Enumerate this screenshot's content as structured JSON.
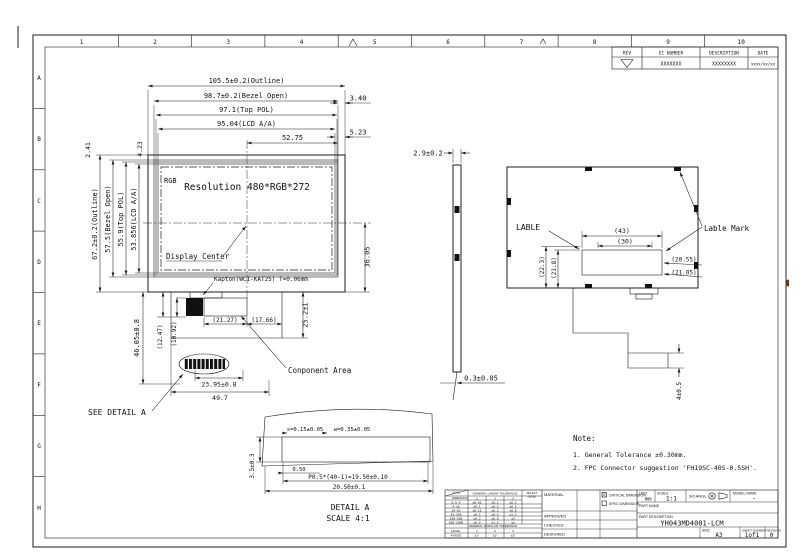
{
  "sheet": {
    "zones_top": [
      "1",
      "2",
      "3",
      "4",
      "5",
      "6",
      "7",
      "8",
      "9",
      "10"
    ],
    "zones_left": [
      "A",
      "B",
      "C",
      "D",
      "E",
      "F",
      "G",
      "H"
    ]
  },
  "rev_table": {
    "headers": [
      "REV",
      "EC NUMBER",
      "DESCRIPTION",
      "DATE"
    ],
    "row": {
      "ec_number": "XXXXXXX",
      "description": "XXXXXXXX",
      "date": "xxxx/xx/xx"
    }
  },
  "front": {
    "dim_outline_w": "105.5±0.2(Outline)",
    "dim_bezel_w": "98.7±0.2(Bezel Open)",
    "dim_pol_w": "97.1(Top POL)",
    "dim_aa_w": "95.04(LCD A/A)",
    "dim_half_w": "52.75",
    "dim_340": "3.40",
    "dim_523": "5.23",
    "dim_241": "2.41",
    "dim_423": "4.23",
    "dim_outline_h": "67.2±0.2(Outline)",
    "dim_bezel_h": "57.5(Bezel Open)",
    "dim_pol_h": "55.9(Top POL)",
    "dim_aa_h": "53.856(LCD A/A)",
    "rgb": "RGB",
    "resolution": "Resolution 480*RGB*272",
    "display_center": "Display Center",
    "kapton": "Kapton(WCI-KAT25) T=0.06mm",
    "dim_3605": "36.05",
    "dim_252": "25.2±1",
    "dim_2127": "(21.27)",
    "dim_1766": "(17.66)",
    "dim_4605": "46.05±0.8",
    "dim_1247": "(12.47)",
    "dim_1092": "(10.92)",
    "dim_2395": "23.95±0.8",
    "dim_497": "49.7",
    "see_detail": "SEE DETAIL A",
    "component_area": "Conponent Area"
  },
  "side": {
    "dim_29": "2.9±0.2",
    "dim_03": "0.3±0.05"
  },
  "back": {
    "lable": "LABLE",
    "lable_mark": "Lable Mark",
    "dim_43": "(43)",
    "dim_30": "(30)",
    "dim_223": "(22.3)",
    "dim_218": "(21.8)",
    "dim_2055": "(20.55)",
    "dim_2105": "(21.05)",
    "dim_4": "4±0.5"
  },
  "detail": {
    "dim_s": "s=0.15±0.05",
    "dim_w": "w=0.35±0.05",
    "dim_050": "0.50",
    "dim_pitch": "P0.5*(40-1)=19.50±0.10",
    "dim_total": "20.50±0.1",
    "dim_35": "3.5±0.3",
    "title": "DETAIL  A",
    "scale": "SCALE  4:1"
  },
  "notes": {
    "heading": "Note:",
    "line1": "1. General Tolerance ±0.30mm.",
    "line2": "2. FPC Connector suggestion 'FH19SC-40S-0.5SH'."
  },
  "title_block": {
    "material": "MATERIAL",
    "approved": "APPROVED",
    "checked": "CHECKED",
    "designed": "DESIGNED",
    "critical": "CRITICAL DIMENSION",
    "spec": "SPEC DIMENSION",
    "unit_label": "UNIT",
    "unit": "mm",
    "scale_label": "SCALE",
    "scale": "1:1",
    "angle": "3rd ANGL",
    "model_label": "MODEL NAME",
    "model": "-",
    "part_name_label": "PART NAME",
    "part_desc_label": "PART DESCRIPTION",
    "part_desc": "YH043MD4001-LCM",
    "size_label": "SIZE",
    "size": "A3",
    "sheet_label": "SHEET NUMBER",
    "sheet": "1of1",
    "rev_label": "REVISION",
    "rev": "0",
    "tol": {
      "level": "LEVEL",
      "dimension": "DIMENSION",
      "linear": "GENERAL LINEAR TOLERANCE",
      "select1": "SELECT",
      "select2": "LEVEL",
      "cols": [
        "1",
        "2",
        "3"
      ],
      "rows": [
        {
          "range": "0.5-4",
          "v1": "±0.05",
          "v2": "±0.1",
          "v3": "±0.2"
        },
        {
          "range": "4-16",
          "v1": "±0.1",
          "v2": "±0.2",
          "v3": "±0.5"
        },
        {
          "range": "16-63",
          "v1": "±0.15",
          "v2": "±0.3",
          "v3": "±0.8"
        },
        {
          "range": "63-250",
          "v1": "±0.2",
          "v2": "±0.5",
          "v3": "±1.2"
        },
        {
          "range": "250-630",
          "v1": "±0.3",
          "v2": "±0.8",
          "v3": "±2"
        },
        {
          "range": "630-1000",
          "v1": "±0.5",
          "v2": "±1.2",
          "v3": "±3"
        }
      ],
      "angular": "GENERAL ANGULAR TOLERANCE",
      "level_row": "LEVEL",
      "range_row": "RANGE",
      "ang_levels": [
        "1",
        "2",
        "3"
      ],
      "ang_values": [
        "±1°",
        "±2°",
        "±3°"
      ]
    }
  }
}
